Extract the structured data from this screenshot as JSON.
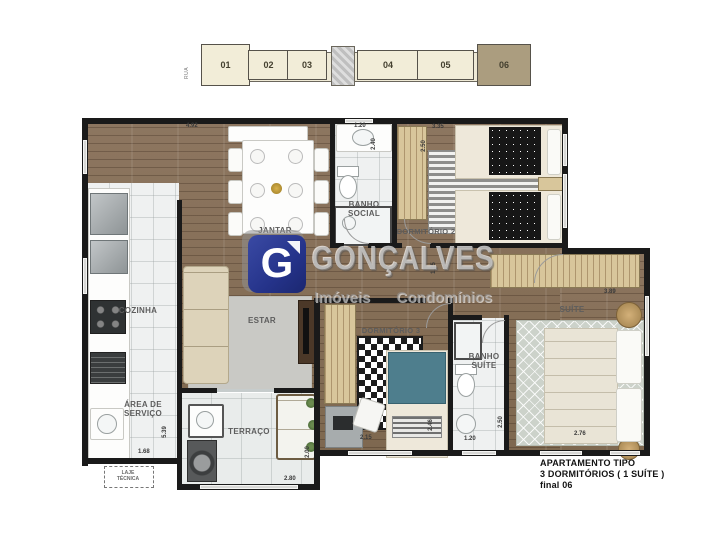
{
  "building": {
    "street_label": "RUA",
    "units": [
      "01",
      "02",
      "03",
      "04",
      "05",
      "06"
    ],
    "highlighted_unit": "06"
  },
  "watermark": {
    "logo_letter": "G",
    "brand": "GONÇALVES",
    "tagline_left": "Imóveis",
    "tagline_right": "Condomínios"
  },
  "rooms": {
    "jantar": "JANTAR",
    "cozinha": "COZINHA",
    "estar": "ESTAR",
    "area_servico": "ÁREA DE SERVIÇO",
    "terraco": "TERRAÇO",
    "laje_tecnica": "LAJE TÉCNICA",
    "banho_social": "BANHO SOCIAL",
    "dormitorio2": "DORMITÓRIO 2",
    "dormitorio3": "DORMITÓRIO 3",
    "banho_suite": "BANHO SUÍTE",
    "suite": "SUÍTE"
  },
  "dimensions": {
    "jantar_w": "4.92",
    "banho_social_w": "1.20",
    "banho_social_h": "2.40",
    "dorm2_w": "3.35",
    "dorm2_h": "2.50",
    "hall_h": "1.15",
    "suite_w": "3.89",
    "suite_bed_w": "2.76",
    "banho_suite_w": "1.20",
    "banho_suite_h": "2.50",
    "dorm3_w": "2.15",
    "dorm3_h": "2.46",
    "terraco_w": "2.80",
    "terraco_h": "2.00",
    "servico_w": "1.68",
    "servico_h": "5.39"
  },
  "title_block": {
    "line1": "APARTAMENTO   TIPO",
    "line2": "3 DORMITÓRIOS ( 1 SUÍTE )",
    "line3": "final 06"
  },
  "colors": {
    "wood_floor": "#87705a",
    "wall": "#1a1a1a",
    "tile": "#eff1f1",
    "unit_fill": "#f2edd8",
    "unit_highlight": "#ab9d7f",
    "logo_blue": "#25338a"
  }
}
